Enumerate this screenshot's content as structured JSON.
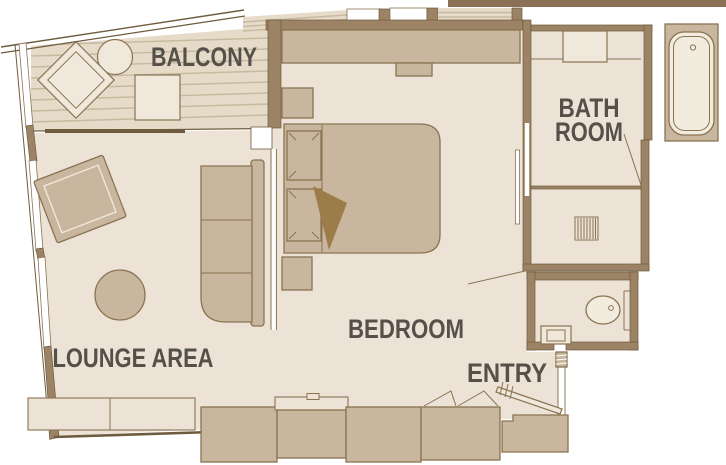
{
  "rooms": {
    "balcony": "BALCONY",
    "lounge": "LOUNGE AREA",
    "bedroom": "BEDROOM",
    "bathroom_line1": "BATH",
    "bathroom_line2": "ROOM",
    "entry": "ENTRY"
  },
  "colors": {
    "background": "#ffffff",
    "floor": "#ece3d6",
    "deck": "#e6dbc8",
    "deck_stripe": "#c7b9a0",
    "wall": "#9c8365",
    "wall_dark": "#6f5b3e",
    "furniture": "#c8b69e",
    "furniture_outline": "#8a7352",
    "furniture_light": "#efe8db",
    "fixture": "#f2ecdf",
    "accent_dark": "#9c7c48",
    "top_band": "#8a7156",
    "label": "#56504a"
  }
}
